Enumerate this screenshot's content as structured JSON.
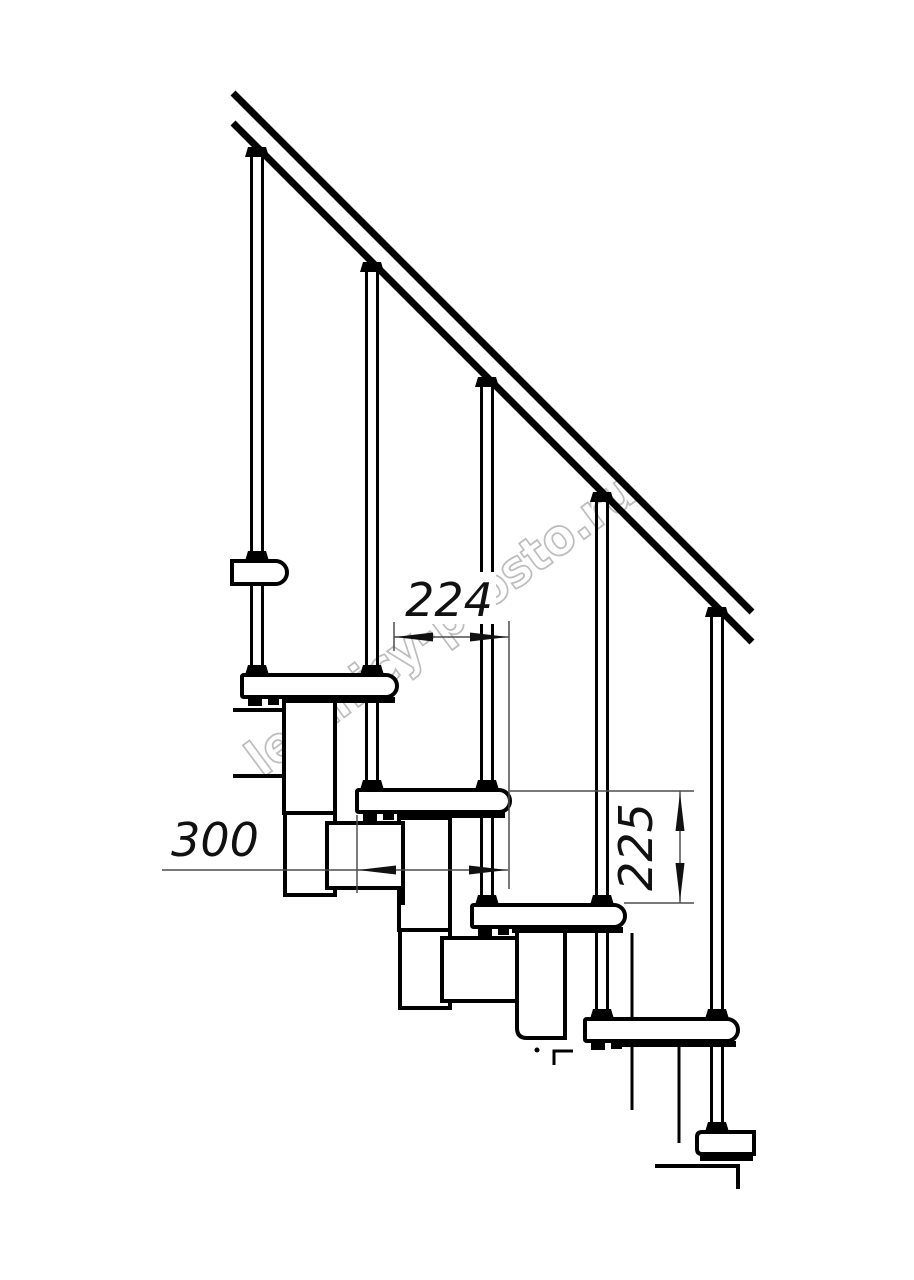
{
  "drawing": {
    "watermark": "lestnicy-prosto.ru",
    "dimensions": {
      "d224": "224",
      "d300": "300",
      "d225": "225"
    },
    "elements": {
      "balusters": 5,
      "treads": 6,
      "handrail_lines": 2
    },
    "colors": {
      "line": "#000000",
      "dimension_line": "#4d4d4d",
      "dimension_text": "#111111",
      "watermark": "#bdbdbd",
      "background": "#ffffff"
    }
  }
}
